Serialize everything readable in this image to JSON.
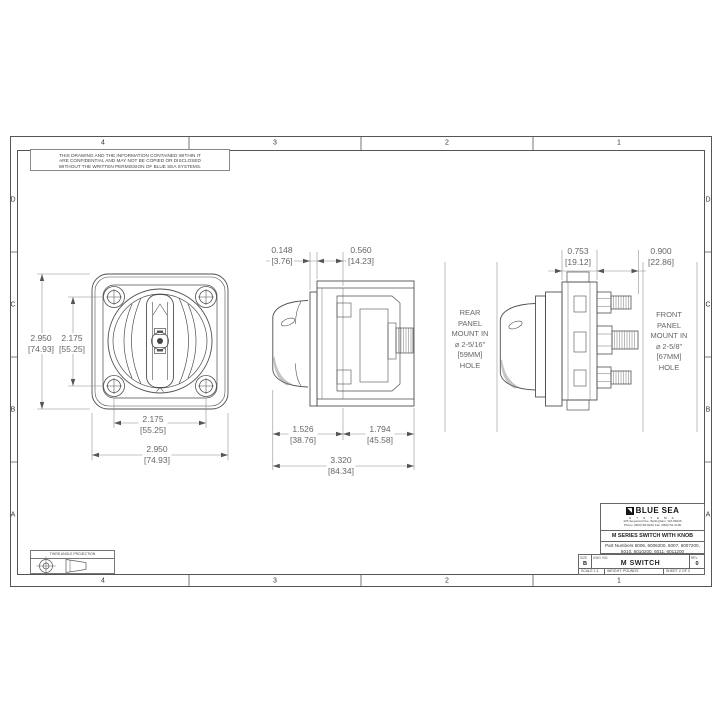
{
  "drawing": {
    "confidentiality_note": "THIS DRAWING AND THE INFORMATION CONTAINED WITHIN IT\nARE CONFIDENTIAL AND MAY NOT BE COPIED OR DISCLOSED\nWITHOUT THE WRITTEN PERMISSION OF BLUE SEA SYSTEMS.",
    "projection_label": "THIRD ANGLE PROJECTION"
  },
  "zones": {
    "columns": [
      "4",
      "3",
      "2",
      "1"
    ],
    "rows": [
      "D",
      "C",
      "B",
      "A"
    ]
  },
  "views": {
    "front": {
      "dims": {
        "height_overall": {
          "in": "2.950",
          "mm": "[74.93]"
        },
        "height_screws": {
          "in": "2.175",
          "mm": "[55.25]"
        },
        "width_screws": {
          "in": "2.175",
          "mm": "[55.25]"
        },
        "width_overall": {
          "in": "2.950",
          "mm": "[74.93]"
        }
      }
    },
    "side": {
      "dims": {
        "panel_thickness": {
          "in": "0.148",
          "mm": "[3.76]"
        },
        "body_step": {
          "in": "0.560",
          "mm": "[14.23]"
        },
        "knob_to_panel": {
          "in": "1.526",
          "mm": "[38.76]"
        },
        "panel_to_stud": {
          "in": "1.794",
          "mm": "[45.58]"
        },
        "overall": {
          "in": "3.320",
          "mm": "[84.34]"
        }
      }
    },
    "rear": {
      "dims": {
        "panel_to_body": {
          "in": "0.753",
          "mm": "[19.12]"
        },
        "body_to_stud": {
          "in": "0.900",
          "mm": "[22.86]"
        }
      },
      "notes": {
        "rear_mount": "REAR\nPANEL\nMOUNT IN\n⌀ 2-5/16\"\n[59MM]\nHOLE",
        "front_mount": "FRONT\nPANEL\nMOUNT IN\n⌀ 2-5/8\"\n[67MM]\nHOLE"
      }
    }
  },
  "title_block": {
    "logo_glyph": "◥",
    "company": "BLUE SEA",
    "company_sub": "S Y S T E M S",
    "address_line1": "425 Sequoia Drive,  Bellingham, WA 98226",
    "address_line2": "Phone (360)738-8230   Fax (360)734-4195",
    "title": "M SERIES SWITCH WITH KNOB",
    "part_numbers_line1": "Part Numbers 6006, 6006200, 6007, 6007200,",
    "part_numbers_line2": "6010, 6010200, 6011, 6011200",
    "size_label": "SIZE",
    "size_value": "B",
    "dwg_label": "DWG. NO.",
    "dwg_value": "M SWITCH",
    "rev_label": "REV",
    "rev_value": "0",
    "scale": "SCALE 1:1",
    "weight": "WEIGHT: POUNDS",
    "sheet": "SHEET 2 OF 3"
  }
}
